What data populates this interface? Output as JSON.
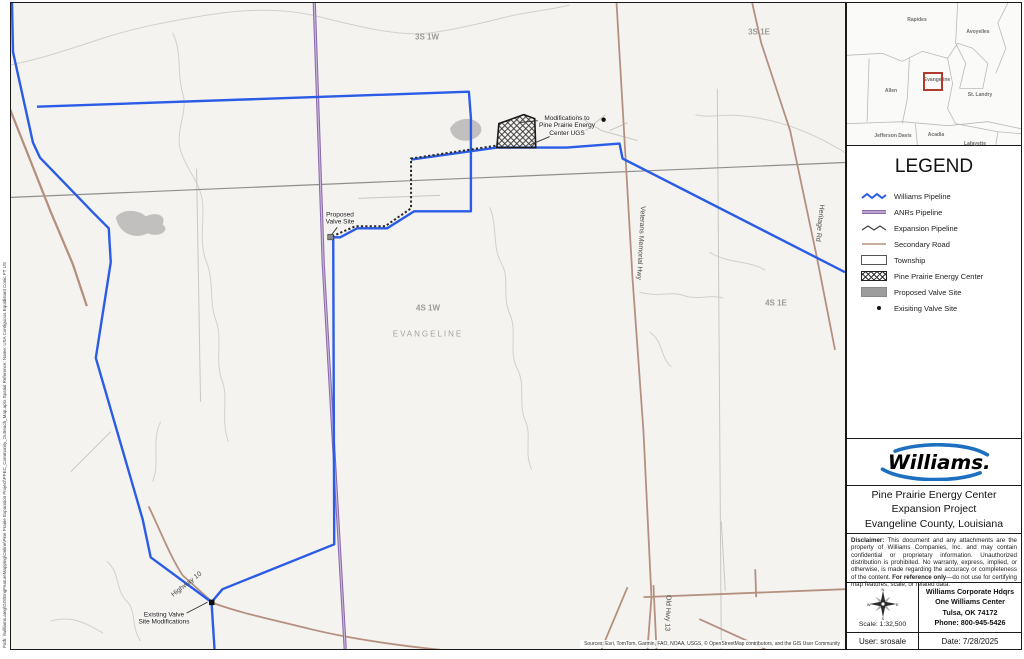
{
  "map": {
    "labels": [
      {
        "id": "township-3s1w",
        "text": "3S 1W",
        "x": 416,
        "y": 34,
        "rot": 0,
        "cls": "lbl-twp"
      },
      {
        "id": "township-3s1e",
        "text": "3S 1E",
        "x": 748,
        "y": 29,
        "rot": 0,
        "cls": "lbl-twp"
      },
      {
        "id": "township-4s1w",
        "text": "4S 1W",
        "x": 417,
        "y": 305,
        "rot": 0,
        "cls": "lbl-twp"
      },
      {
        "id": "township-4s1e",
        "text": "4S 1E",
        "x": 765,
        "y": 300,
        "rot": 0,
        "cls": "lbl-twp"
      },
      {
        "id": "county-evangeline",
        "text": "EVANGELINE",
        "x": 417,
        "y": 331,
        "rot": 0,
        "cls": "lbl-county"
      },
      {
        "id": "road-veterans-memorial-hwy",
        "text": "Veterans Memorial Hwy",
        "x": 629,
        "y": 240,
        "rot": 93,
        "cls": "lbl-road"
      },
      {
        "id": "road-heritage-rd",
        "text": "Heritage Rd",
        "x": 808,
        "y": 220,
        "rot": 96,
        "cls": "lbl-road"
      },
      {
        "id": "road-old-hwy-13",
        "text": "Old Hwy 13",
        "x": 656,
        "y": 610,
        "rot": 92,
        "cls": "lbl-road"
      },
      {
        "id": "road-highway-10",
        "text": "Highway 10",
        "x": 176,
        "y": 582,
        "rot": -38,
        "cls": "lbl-road"
      },
      {
        "id": "callout-ugs",
        "text": "Modifications to\nPine Prairie Energy\nCenter UGS",
        "x": 556,
        "y": 123,
        "rot": 0,
        "cls": "lbl-callout"
      },
      {
        "id": "callout-proposed-valve",
        "text": "Proposed\nValve Site",
        "x": 329,
        "y": 216,
        "rot": 0,
        "cls": "lbl-callout"
      },
      {
        "id": "callout-existing-valve",
        "text": "Existing Valve\nSite Modifications",
        "x": 153,
        "y": 616,
        "rot": 0,
        "cls": "lbl-callout"
      }
    ],
    "sources_note": "Sources: Esri, TomTom, Garmin, FAO, NOAA, USGS, © OpenStreetMap contributors, and the GIS User Community",
    "side_note": "Path: \\\\williams.amg\\GIS\\EngFeatureMapping\\Online\\Pine Prairie Expansion Project\\PPEC_Community_Outreach_Map.aprx     Spatial Reference: Name: USA Contiguous Equidistant Conic FT US"
  },
  "inset": {
    "parishes": [
      {
        "name": "Rapides",
        "x": 70,
        "y": 17
      },
      {
        "name": "Avoyelles",
        "x": 131,
        "y": 29
      },
      {
        "name": "Allen",
        "x": 44,
        "y": 88
      },
      {
        "name": "Evangeline",
        "x": 90,
        "y": 77
      },
      {
        "name": "St. Landry",
        "x": 133,
        "y": 92
      },
      {
        "name": "Jefferson Davis",
        "x": 46,
        "y": 133
      },
      {
        "name": "Acadia",
        "x": 89,
        "y": 132
      },
      {
        "name": "Lafayette",
        "x": 128,
        "y": 141
      }
    ]
  },
  "legend": {
    "title": "LEGEND",
    "items": [
      {
        "label": "Williams Pipeline",
        "swatch": "williams"
      },
      {
        "label": "ANRs Pipeline",
        "swatch": "anr"
      },
      {
        "label": "Expansion Pipeline",
        "swatch": "expansion"
      },
      {
        "label": "Secondary Road",
        "swatch": "road"
      },
      {
        "label": "Township",
        "swatch": "township"
      },
      {
        "label": "Pine Prairie Energy Center",
        "swatch": "ppec"
      },
      {
        "label": "Proposed Valve Site",
        "swatch": "proposed"
      },
      {
        "label": "Exisiting Valve Site",
        "swatch": "existing"
      }
    ]
  },
  "logo": {
    "text": "Williams."
  },
  "title_block": {
    "line1": "Pine Prairie Energy Center",
    "line2": "Expansion Project",
    "line3": "Evangeline County, Louisiana"
  },
  "disclaimer": {
    "label": "Disclaimer:",
    "body": " This document and any attachments are the property of Williams Companies, Inc. and may contain confidential or proprietary information. Unauthorized distribution is prohibited. No warranty, express, implied, or otherwise, is made regarding the accuracy or completeness of the content. ",
    "ref_bold": "For reference only",
    "tail": "—do not use for certifying map features, scale, or related data."
  },
  "info": {
    "scale": "Scale: 1:32,500",
    "compass": {
      "n": "N",
      "e": "E",
      "s": "S",
      "w": "W"
    },
    "address1": "Williams Corporate Hdqrs",
    "address2": "One Williams Center",
    "address3": "Tulsa, OK  74172",
    "address4": "Phone: 800-945-5426",
    "user": "User: srosale",
    "date": "Date: 7/28/2025"
  },
  "colors": {
    "williams_pipeline": "#2a5ce6",
    "anr_pipeline": "#8a6aaa",
    "expansion_pipeline": "#2a2a2a",
    "secondary_road": "#b5907f",
    "locator_box_red": "#b03a2e",
    "logo_blue": "#1d6fc0"
  }
}
